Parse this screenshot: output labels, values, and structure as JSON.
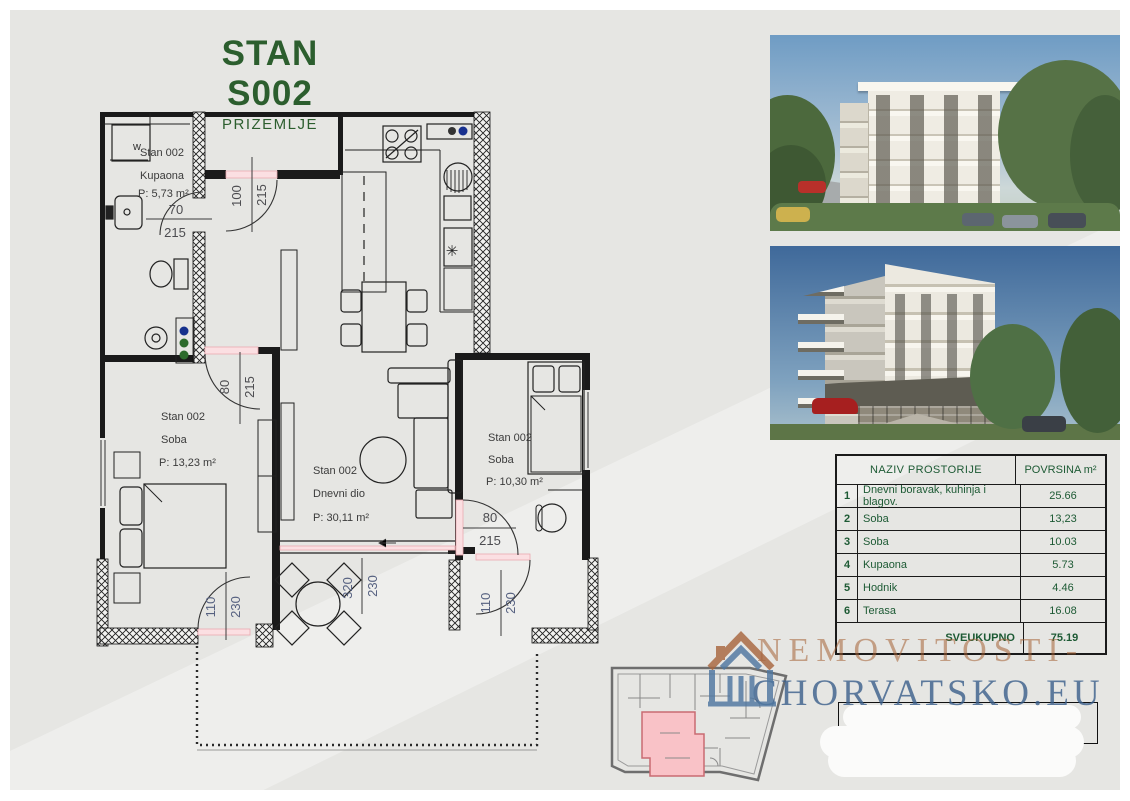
{
  "page": {
    "title": "STAN S002",
    "subtitle": "PRIZEMLJE"
  },
  "floor_plan": {
    "washer_label": "w",
    "appliance_symbol": "✳",
    "rooms": [
      {
        "line1": "Stan 002",
        "line2": "Kupaona",
        "area": "P: 5,73 m²"
      },
      {
        "line1": "Stan 002",
        "line2": "Soba",
        "area": "P: 13,23 m²"
      },
      {
        "line1": "Stan 002",
        "line2": "Dnevni dio",
        "area": "P: 30,11 m²"
      },
      {
        "line1": "Stan 002",
        "line2": "Soba",
        "area": "P: 10,30 m²"
      }
    ],
    "dimensions": [
      {
        "label": "bathroom-door",
        "w": "70",
        "h": "215"
      },
      {
        "label": "entrance-door",
        "w": "100",
        "h": "215"
      },
      {
        "label": "bedroom1-door",
        "w": "80",
        "h": "215"
      },
      {
        "label": "bedroom2-door",
        "w": "80",
        "h": "215"
      },
      {
        "label": "bedroom1-terrace-door",
        "w": "110",
        "h": "230"
      },
      {
        "label": "living-terrace-window",
        "w": "320",
        "h": "230"
      },
      {
        "label": "bedroom2-terrace-door",
        "w": "110",
        "h": "230"
      }
    ]
  },
  "area_table": {
    "header": {
      "name": "NAZIV PROSTORIJE",
      "area": "POVRSINA m²"
    },
    "rows": [
      {
        "num": "1",
        "name": "Dnevni boravak, kuhinja i blagov.",
        "area": "25.66"
      },
      {
        "num": "2",
        "name": "Soba",
        "area": "13,23"
      },
      {
        "num": "3",
        "name": "Soba",
        "area": "10.03"
      },
      {
        "num": "4",
        "name": "Kupaona",
        "area": "5.73"
      },
      {
        "num": "5",
        "name": "Hodnik",
        "area": "4.46"
      },
      {
        "num": "6",
        "name": "Terasa",
        "area": "16.08"
      }
    ],
    "total_label": "SVEUKUPNO",
    "total_value": "75.19"
  },
  "watermark": {
    "line1": "NEMOVITOSTI-",
    "line2": "CHORVATSKO.EU"
  },
  "colors": {
    "title_green": "#2c5e2e",
    "table_green": "#1d5a34",
    "unit_highlight_pink": "#f9c2c7",
    "door_opening_pink": "#f3b9bf",
    "watermark_brown": "#a4613a",
    "watermark_blue": "#3a5e8a"
  }
}
